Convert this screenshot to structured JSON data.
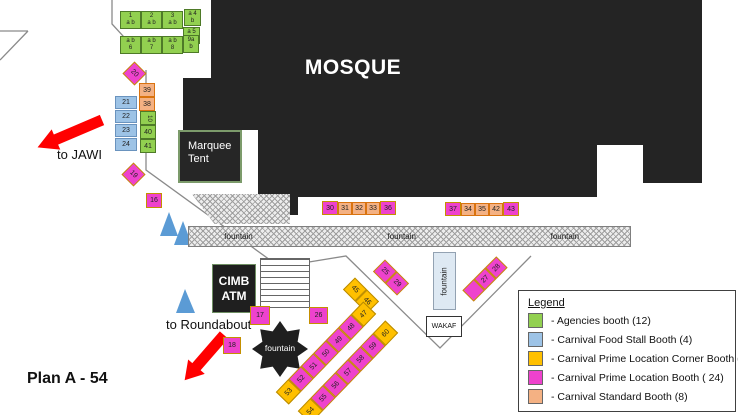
{
  "plan_title": "Plan A - 54",
  "mosque_label": "MOSQUE",
  "marquee_tent_label": "Marquee Tent",
  "cimb_atm_lines": [
    "CIMB",
    "ATM"
  ],
  "wakaf_label": "WAKAF",
  "fountain_bar_labels": [
    "fountain",
    "fountain",
    "fountain"
  ],
  "fountain_vertical_label": "fountain",
  "fountain_star_label": "fountain",
  "to_jawi_label": "to JAWI",
  "to_roundabout_label": "to Roundabout",
  "legend": {
    "title": "Legend",
    "items": [
      {
        "color": "#92D050",
        "label": "- Agencies booth (12)"
      },
      {
        "color": "#9DC3E6",
        "label": "- Carnival Food Stall Booth (4)"
      },
      {
        "color": "#FFC000",
        "label": "- Carnival Prime Location Corner Booth (6)"
      },
      {
        "color": "#EE42CD",
        "label": "- Carnival Prime Location Booth ( 24)"
      },
      {
        "color": "#F4B183",
        "label": "- Carnival Standard Booth (8)"
      }
    ]
  },
  "booth_colors": {
    "agencies": "#92D050",
    "food_stall": "#9DC3E6",
    "prime_corner": "#FFC000",
    "prime": "#EE42CD",
    "standard": "#F4B183"
  },
  "booths": [
    {
      "lines": [
        "1",
        "a b"
      ],
      "n": "1",
      "t": "green",
      "x": 120,
      "y": 11,
      "w": 21,
      "h": 18
    },
    {
      "lines": [
        "2",
        "a b"
      ],
      "n": "2",
      "t": "green",
      "x": 141,
      "y": 11,
      "w": 21,
      "h": 18
    },
    {
      "lines": [
        "3",
        "a b"
      ],
      "n": "3",
      "t": "green",
      "x": 162,
      "y": 11,
      "w": 21,
      "h": 18
    },
    {
      "lines": [
        "a 4",
        "b"
      ],
      "n": "4",
      "t": "green",
      "x": 184,
      "y": 9,
      "w": 17,
      "h": 17
    },
    {
      "lines": [
        "a 5",
        "b"
      ],
      "n": "5",
      "t": "green",
      "x": 183,
      "y": 27,
      "w": 17,
      "h": 17
    },
    {
      "lines": [
        "a b",
        "6"
      ],
      "n": "6",
      "t": "green",
      "x": 120,
      "y": 36,
      "w": 21,
      "h": 18
    },
    {
      "lines": [
        "a b",
        "7"
      ],
      "n": "7",
      "t": "green",
      "x": 141,
      "y": 36,
      "w": 21,
      "h": 18
    },
    {
      "lines": [
        "a b",
        "8"
      ],
      "n": "8",
      "t": "green",
      "x": 162,
      "y": 36,
      "w": 21,
      "h": 18
    },
    {
      "lines": [
        "9a",
        "b"
      ],
      "n": "9",
      "t": "green",
      "x": 183,
      "y": 35,
      "w": 16,
      "h": 18
    },
    {
      "n": "10",
      "vert": true,
      "t": "green",
      "x": 140,
      "y": 111,
      "w": 16,
      "h": 14
    },
    {
      "n": "40",
      "t": "green",
      "x": 140,
      "y": 125,
      "w": 16,
      "h": 14
    },
    {
      "n": "41",
      "t": "green",
      "x": 140,
      "y": 139,
      "w": 16,
      "h": 14
    },
    {
      "n": "39",
      "t": "orange",
      "x": 139,
      "y": 83,
      "w": 16,
      "h": 14
    },
    {
      "n": "38",
      "t": "orange",
      "x": 139,
      "y": 97,
      "w": 16,
      "h": 14
    },
    {
      "n": "21",
      "t": "blue",
      "x": 115,
      "y": 96,
      "w": 22,
      "h": 13
    },
    {
      "n": "22",
      "t": "blue",
      "x": 115,
      "y": 110,
      "w": 22,
      "h": 13
    },
    {
      "n": "23",
      "t": "blue",
      "x": 115,
      "y": 124,
      "w": 22,
      "h": 13
    },
    {
      "n": "24",
      "t": "blue",
      "x": 115,
      "y": 138,
      "w": 22,
      "h": 13
    },
    {
      "n": "16",
      "t": "pink",
      "x": 146,
      "y": 193,
      "w": 16,
      "h": 15
    },
    {
      "n": "17",
      "t": "pink",
      "x": 250,
      "y": 306,
      "w": 20,
      "h": 19
    },
    {
      "n": "18",
      "t": "pink",
      "x": 223,
      "y": 337,
      "w": 18,
      "h": 17
    },
    {
      "n": "26",
      "t": "pink",
      "x": 309,
      "y": 307,
      "w": 19,
      "h": 17
    },
    {
      "n": "30",
      "t": "pink",
      "x": 322,
      "y": 201,
      "w": 16,
      "h": 14
    },
    {
      "n": "31",
      "t": "orange",
      "x": 338,
      "y": 202,
      "w": 14,
      "h": 13
    },
    {
      "n": "32",
      "t": "orange",
      "x": 352,
      "y": 202,
      "w": 14,
      "h": 13
    },
    {
      "n": "33",
      "t": "orange",
      "x": 366,
      "y": 202,
      "w": 14,
      "h": 13
    },
    {
      "n": "36",
      "t": "pink",
      "x": 380,
      "y": 201,
      "w": 16,
      "h": 14
    },
    {
      "n": "37",
      "t": "pink",
      "x": 445,
      "y": 202,
      "w": 16,
      "h": 14
    },
    {
      "n": "34",
      "t": "orange",
      "x": 461,
      "y": 203,
      "w": 14,
      "h": 13
    },
    {
      "n": "35",
      "t": "orange",
      "x": 475,
      "y": 203,
      "w": 14,
      "h": 13
    },
    {
      "n": "42",
      "t": "orange",
      "x": 489,
      "y": 203,
      "w": 14,
      "h": 13
    },
    {
      "n": "43",
      "t": "pink",
      "x": 503,
      "y": 202,
      "w": 16,
      "h": 14
    }
  ],
  "strips": [
    {
      "name": "booth-20",
      "cells": [
        {
          "n": "20",
          "t": "pink"
        }
      ],
      "cx": 134,
      "cy": 73,
      "cell": 17,
      "rot": 45
    },
    {
      "name": "booth-19",
      "cells": [
        {
          "n": "19",
          "t": "pink"
        }
      ],
      "cx": 133,
      "cy": 174,
      "cell": 17,
      "rot": 45
    },
    {
      "name": "booths-45-46",
      "cells": [
        {
          "n": "45",
          "t": "yellow"
        },
        {
          "n": "46",
          "t": "yellow"
        }
      ],
      "cx": 361,
      "cy": 295,
      "cell": 17,
      "rot": 45
    },
    {
      "name": "booths-25-29",
      "cells": [
        {
          "n": "25",
          "t": "pink"
        },
        {
          "n": "29",
          "t": "pink"
        }
      ],
      "cx": 391,
      "cy": 277,
      "cell": 17,
      "rot": 45
    },
    {
      "name": "booths-27-28",
      "cells": [
        {
          "n": "",
          "t": "pink"
        },
        {
          "n": "27",
          "t": "pink"
        },
        {
          "n": "28",
          "t": "pink"
        }
      ],
      "cx": 485,
      "cy": 279,
      "cell": 16,
      "rot": -45
    },
    {
      "name": "booths-47-53",
      "cells": [
        {
          "n": "53",
          "t": "yellow"
        },
        {
          "n": "52",
          "t": "pink"
        },
        {
          "n": "51",
          "t": "pink"
        },
        {
          "n": "50",
          "t": "pink"
        },
        {
          "n": "49",
          "t": "pink"
        },
        {
          "n": "48",
          "t": "pink"
        },
        {
          "n": "47",
          "t": "yellow"
        }
      ],
      "cx": 326,
      "cy": 353,
      "cell": 18,
      "rot": -46
    },
    {
      "name": "booths-54-60",
      "cells": [
        {
          "n": "54",
          "t": "yellow"
        },
        {
          "n": "55",
          "t": "pink"
        },
        {
          "n": "56",
          "t": "pink"
        },
        {
          "n": "57",
          "t": "pink"
        },
        {
          "n": "58",
          "t": "pink"
        },
        {
          "n": "59",
          "t": "pink"
        },
        {
          "n": "60",
          "t": "yellow"
        }
      ],
      "cx": 348,
      "cy": 372,
      "cell": 18,
      "rot": -46
    }
  ]
}
